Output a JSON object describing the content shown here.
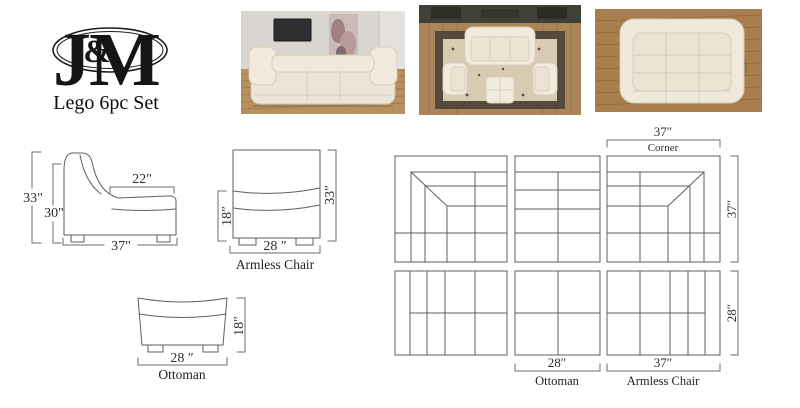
{
  "logo": {
    "j": "J",
    "amp": "&",
    "m": "M",
    "title": "Lego 6pc Set"
  },
  "photos": {
    "front": "sofa-lifestyle-front-view-photo",
    "top": "sofa-lifestyle-top-view-photo",
    "pit": "sofa-pit-configuration-photo"
  },
  "side_view": {
    "total_height": "33\"",
    "back_height": "30\"",
    "seat_depth": "22\"",
    "total_depth": "37\""
  },
  "armless_chair": {
    "seat_height": "18″",
    "total_height": "33″",
    "width": "28 ″",
    "label": "Armless Chair"
  },
  "ottoman": {
    "height": "18″",
    "width": "28 ″",
    "label": "Ottoman"
  },
  "plan": {
    "corner_width": "37″",
    "corner_label": "Corner",
    "corner_depth": "37″",
    "row2_depth": "28″",
    "ottoman_width": "28″",
    "ottoman_label": "Ottoman",
    "armless_width": "37″",
    "armless_label": "Armless Chair"
  },
  "colors": {
    "drawing_line": "#5f5f5f",
    "ink": "#151515",
    "sofa_cream": "#f0e9db",
    "wood_floor": "#b0895a"
  }
}
